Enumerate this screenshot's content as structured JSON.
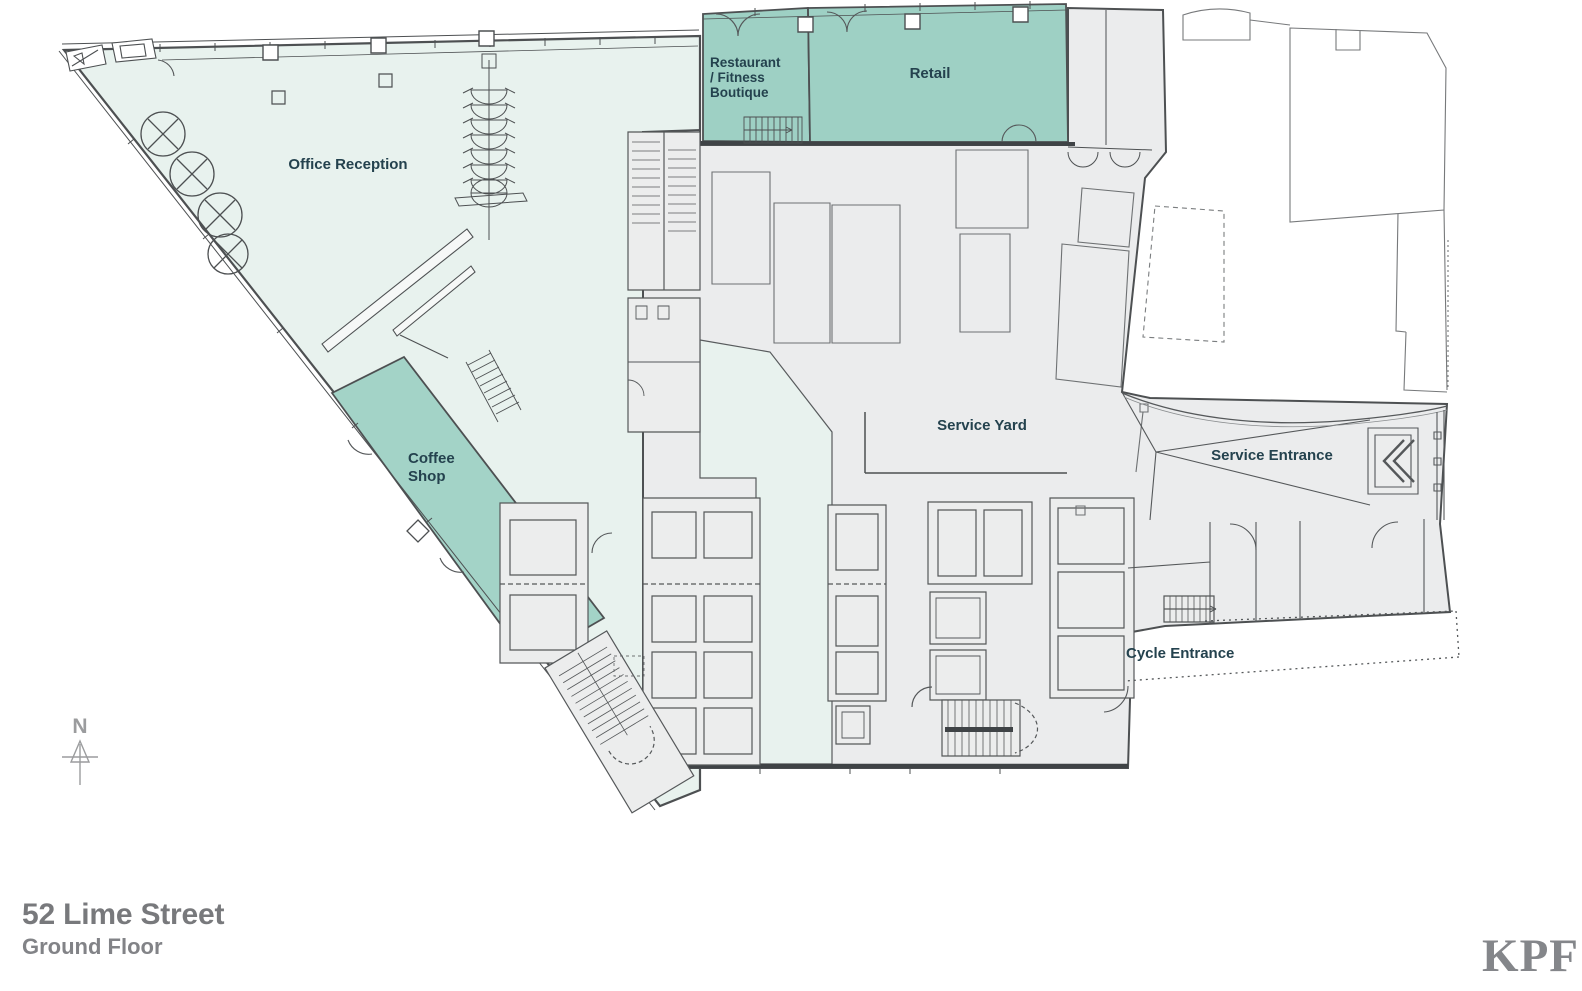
{
  "titleBlock": {
    "project": "52 Lime Street",
    "floor": "Ground Floor"
  },
  "brand": {
    "logo": "KPF"
  },
  "compass": {
    "label": "N"
  },
  "plan": {
    "zones": [
      {
        "id": "office-reception",
        "name": "Office Reception",
        "category": "office lobby",
        "fill": "#e8f2ee"
      },
      {
        "id": "restaurant-fitness-boutique",
        "name": "Restaurant / Fitness Boutique",
        "category": "amenity",
        "fill": "#9ed0c4"
      },
      {
        "id": "retail",
        "name": "Retail",
        "category": "amenity",
        "fill": "#9ed0c4"
      },
      {
        "id": "coffee-shop",
        "name": "Coffee Shop",
        "category": "amenity",
        "fill": "#a3d3c7"
      },
      {
        "id": "service-yard",
        "name": "Service Yard",
        "category": "service",
        "fill": "#ebeced"
      },
      {
        "id": "service-entrance",
        "name": "Service Entrance",
        "category": "service",
        "fill": "#ebeced"
      },
      {
        "id": "cycle-entrance",
        "name": "Cycle Entrance",
        "category": "access",
        "fill": "#ffffff"
      }
    ],
    "labels": {
      "office_reception": "Office Reception",
      "restaurant_1": "Restaurant",
      "restaurant_2": "/ Fitness",
      "restaurant_3": "Boutique",
      "retail": "Retail",
      "coffee_1": "Coffee",
      "coffee_2": "Shop",
      "service_yard": "Service Yard",
      "service_entrance": "Service Entrance",
      "cycle_entrance": "Cycle Entrance"
    }
  },
  "colors": {
    "amenity_teal": "#9ed0c4",
    "coffee_teal": "#a3d3c7",
    "lobby_mint": "#e8f2ee",
    "service_gray": "#ebeced",
    "wall": "#4d5052",
    "line_light": "#8a8d8f",
    "label_text": "#24424e",
    "title_text": "#78797c",
    "subtitle_text": "#828387",
    "logo_text": "#84868a",
    "compass_gray": "#9b9c9e"
  }
}
